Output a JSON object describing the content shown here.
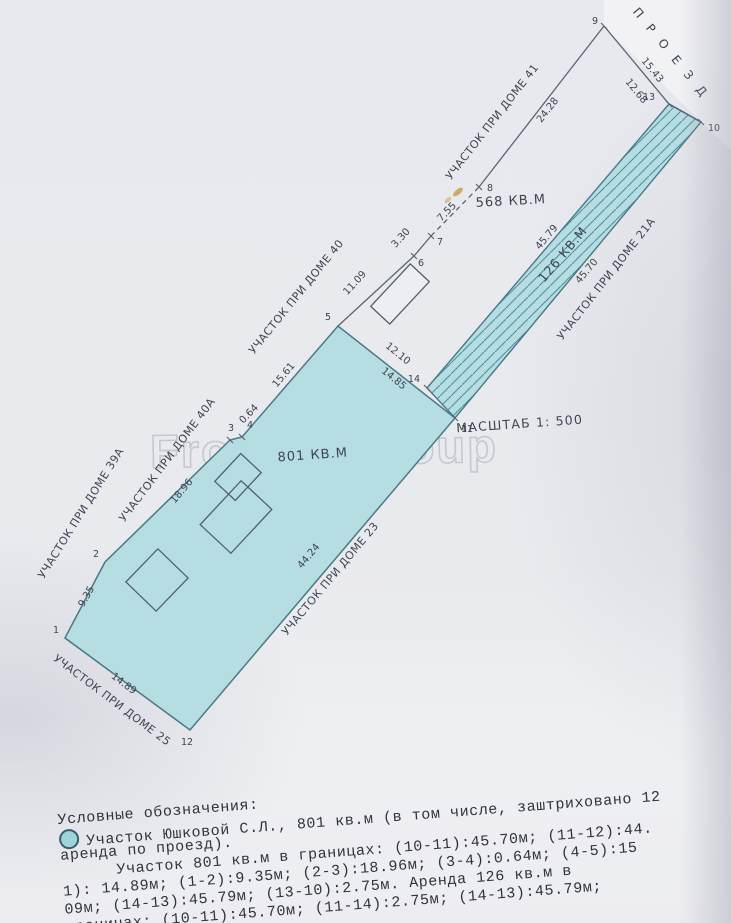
{
  "road_label": "П Р О Е З Д",
  "scale_label": "МАСШТАБ 1: 500",
  "areas": {
    "a568": "568 КВ.М",
    "a801": "801 КВ.М",
    "a126": "126 КВ.М"
  },
  "parcels": {
    "p41": "УЧАСТОК ПРИ ДОМЕ 41",
    "p40": "УЧАСТОК ПРИ ДОМЕ 40",
    "p40a": "УЧАСТОК ПРИ ДОМЕ 40А",
    "p39a": "УЧАСТОК ПРИ ДОМЕ 39А",
    "p25": "УЧАСТОК ПРИ ДОМЕ 25",
    "p23": "УЧАСТОК ПРИ ДОМЕ 23",
    "p21a": "УЧАСТОК ПРИ ДОМЕ 21А"
  },
  "dims": {
    "d1543": "15.43",
    "d1268": "12.68",
    "d2428": "24.28",
    "d755": "7.55",
    "d330": "3.30",
    "d1109": "11.09",
    "d1210": "12.10",
    "d1485": "14.85",
    "d4579": "45.79",
    "d4570": "45.70",
    "d1896": "18.96",
    "d1561": "15.61",
    "d064": "0.64",
    "d4424": "44.24",
    "d1489": "14.89",
    "d935": "9.35"
  },
  "points": {
    "p1": "1",
    "p2": "2",
    "p3": "3",
    "p4": "4",
    "p5": "5",
    "p6": "6",
    "p7": "7",
    "p8": "8",
    "p9": "9",
    "p10": "10",
    "p11": "11",
    "p12": "12",
    "p13": "13",
    "p14": "14"
  },
  "watermark": "Fromax Group",
  "legend": {
    "lines": [
      "Условные обозначения:",
      "Участок Юшковой С.Л., 801 кв.м (в том числе, заштриховано 12",
      "аренда по проезд).",
      "Участок 801 кв.м в границах:  (10-11):45.70м;  (11-12):44.",
      "1):  14.89м;  (1-2):9.35м;  (2-3):18.96м;  (3-4):0.64м;  (4-5):15",
      "09м;  (14-13):45.79м;  (13-10):2.75м.  Аренда 126 кв.м в",
      "границах:  (10-11):45.70м;  (11-14):2.75м;  (14-13):45.79м;"
    ]
  },
  "colors": {
    "parcel_fill": "#b6dde2",
    "hatch_line": "#4e8fa0",
    "boundary": "#5a6472",
    "red_text": "#c0504a",
    "paper": "#e9eaee"
  }
}
